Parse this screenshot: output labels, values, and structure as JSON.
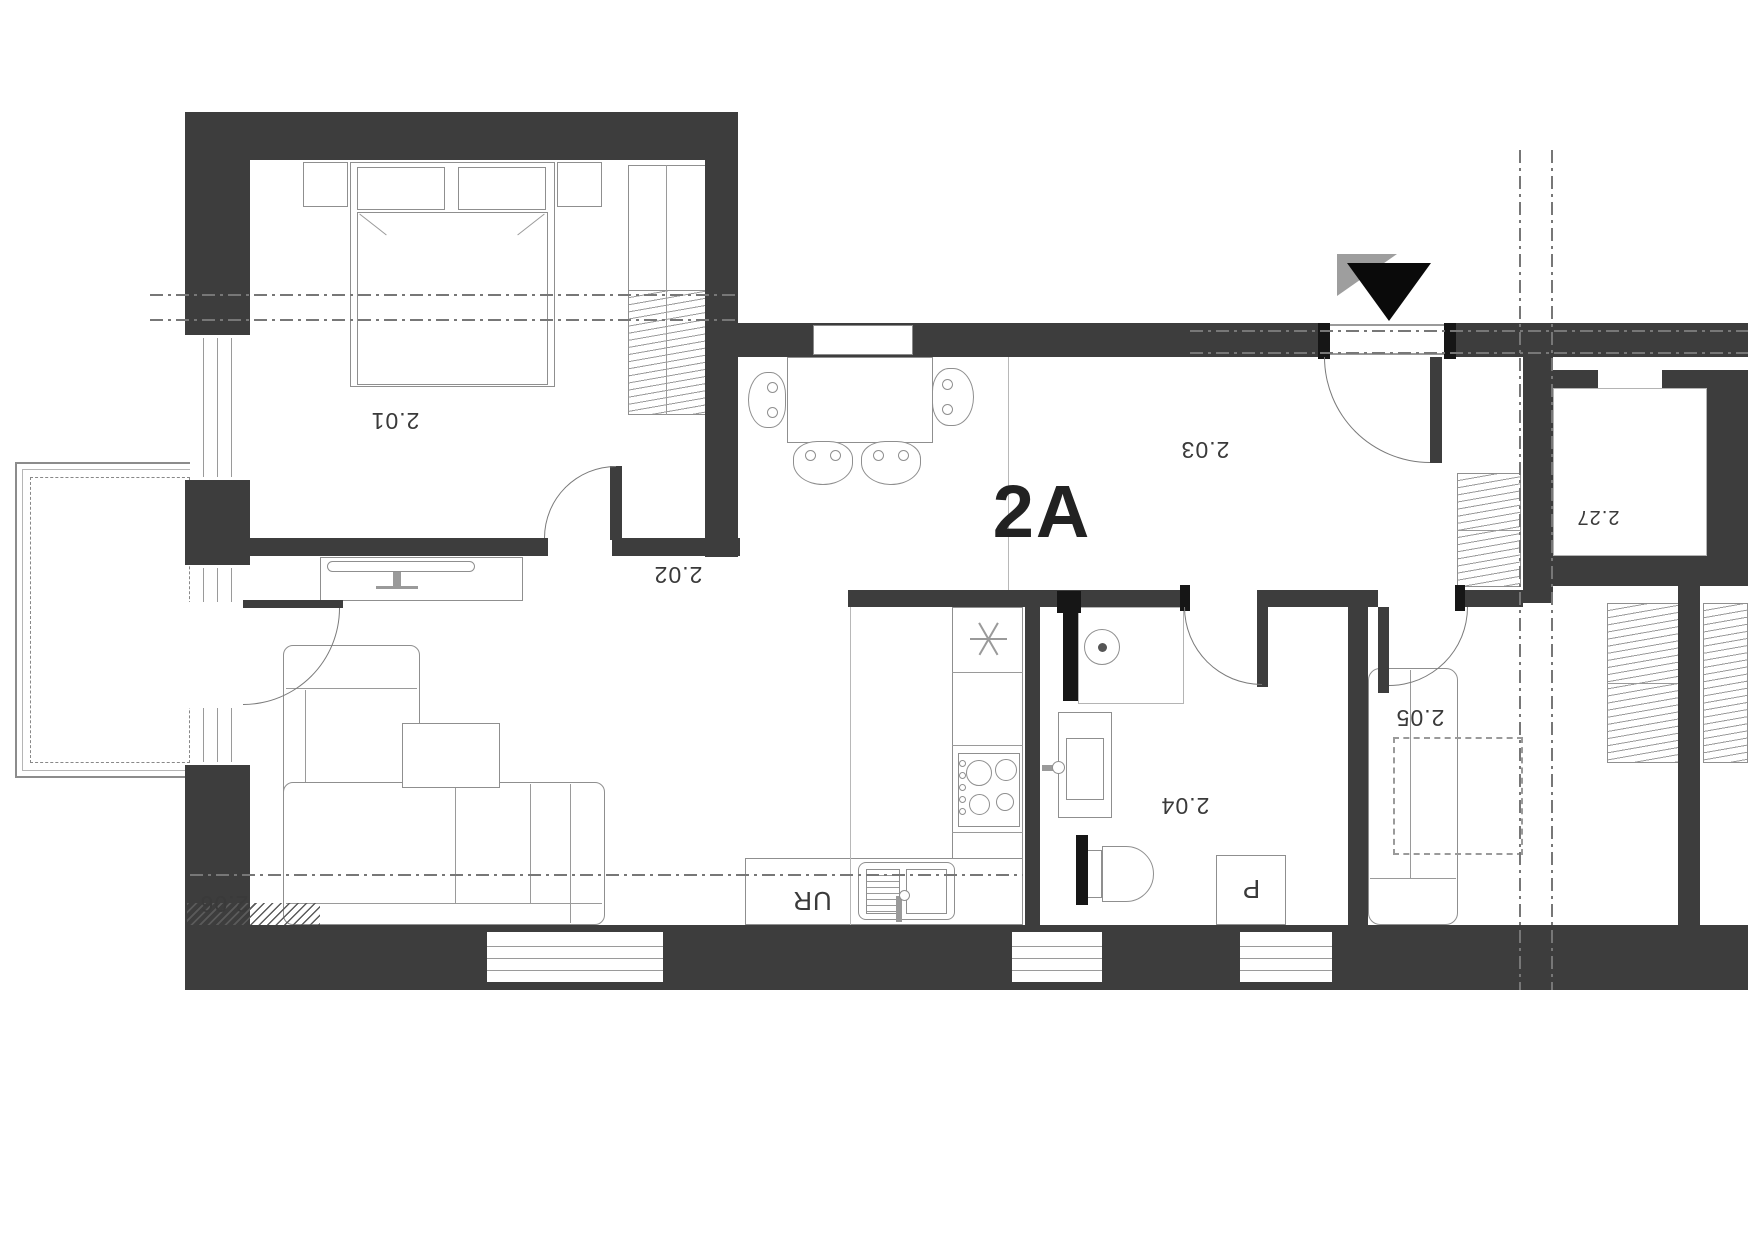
{
  "unit": {
    "label": "2A"
  },
  "rooms": [
    {
      "label": "2.01"
    },
    {
      "label": "2.02"
    },
    {
      "label": "2.03"
    },
    {
      "label": "2.04"
    },
    {
      "label": "2.05"
    },
    {
      "label": "2.06"
    },
    {
      "label": "2.27"
    }
  ],
  "annotations": {
    "sink_unit": "UR",
    "washing_machine": "P"
  },
  "icons": {
    "fridge": "asterisk-snowflake",
    "entrance_marker": "filled-triangle-down"
  },
  "colors": {
    "wall": "#3d3d3d",
    "furniture_line": "#8f8f8f",
    "label": "#3a3a3a",
    "entrance_marker": "#0a0a0a"
  }
}
